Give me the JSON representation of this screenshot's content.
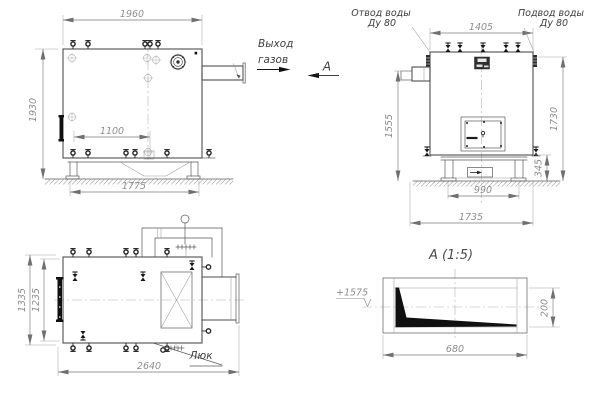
{
  "side_view": {
    "dim_width": "1960",
    "dim_height": "1930",
    "dim_valves": "1100",
    "dim_base": "1775"
  },
  "front_view": {
    "dim_top": "1405",
    "dim_left": "1555",
    "dim_right": "1730",
    "dim_base_h": "345",
    "dim_base_inner": "990",
    "dim_base_outer": "1735",
    "outlet_label": "Отвод воды",
    "outlet_dn": "Ду 80",
    "inlet_label": "Подвод воды",
    "inlet_dn": "Ду 80"
  },
  "plan_view": {
    "dim_width": "1335",
    "dim_width_inner": "1235",
    "dim_length": "2640",
    "hatch_label": "Люк"
  },
  "detail_view": {
    "title": "А  (1:5)",
    "dim_height": "200",
    "dim_width": "680",
    "elevation_mark": "+1575"
  },
  "annotations": {
    "gas_line1": "Выход",
    "gas_line2": "газов",
    "section_letter": "А"
  },
  "colors": {
    "line": "#4e4e4e",
    "dim_text": "#8d8d8d",
    "label_text": "#3e3e3e",
    "black": "#101010",
    "background": "#ffffff"
  }
}
